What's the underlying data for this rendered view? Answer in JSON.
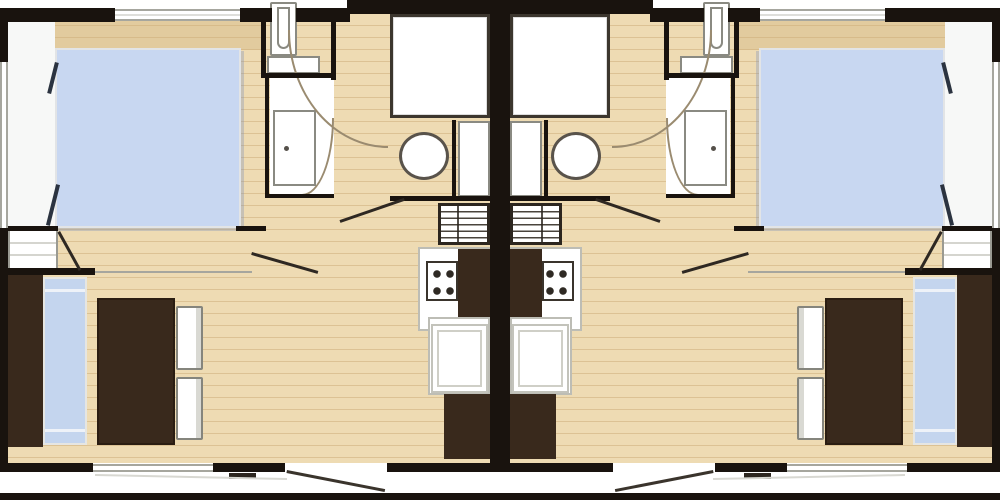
{
  "plan": {
    "type": "mobile-home floor plan, two mirrored twin units",
    "units": 2,
    "mirrored": true,
    "rooms_per_unit": [
      "bedroom",
      "shower-room",
      "wc",
      "washbasin-area",
      "kitchen",
      "living-dining"
    ],
    "objects_per_unit": {
      "double-bed": 1,
      "bench-sofa": 1,
      "dining-table": 1,
      "chairs": 2,
      "shower": 1,
      "toilet": 1,
      "washbasin": 1,
      "water-heater-flue": 1,
      "stove": 1,
      "kitchen-counters": 2,
      "shelf-unit": 1
    }
  },
  "colors": {
    "wall": "#19130e",
    "dark_line": "#2e2822",
    "wood": "#eedbb3",
    "wood_line": "#dcc294",
    "off_white": "#f7f8f7",
    "bed_blue": "#c8d7f1",
    "sofa_blue": "#c4d5ee",
    "brown": "#39291c",
    "fixture_border": "#8a8a82",
    "light_border": "#bdbdb5",
    "line_gray": "#a6a69e",
    "arc": "#9a8b70"
  }
}
